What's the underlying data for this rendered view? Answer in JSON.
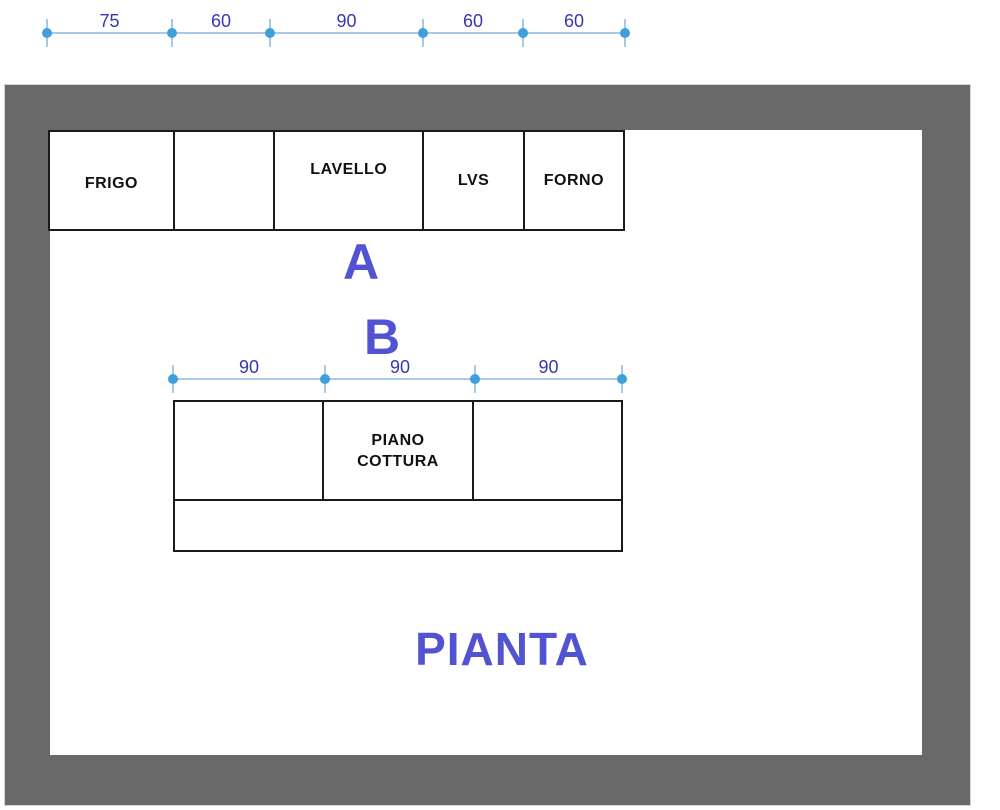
{
  "plan": {
    "title": "PIANTA",
    "section_labels": {
      "a": "A",
      "b": "B"
    },
    "top_run": {
      "dimensions": [
        "75",
        "60",
        "90",
        "60",
        "60"
      ],
      "cells": [
        {
          "label": "FRIGO"
        },
        {
          "label": ""
        },
        {
          "label": "LAVELLO"
        },
        {
          "label": "LVS"
        },
        {
          "label": "FORNO"
        }
      ]
    },
    "island": {
      "dimensions": [
        "90",
        "90",
        "90"
      ],
      "cells": [
        {
          "label": ""
        },
        {
          "label": "PIANO COTTURA"
        },
        {
          "label": ""
        }
      ]
    },
    "colors": {
      "wall": "#696969",
      "dim_line": "#a9c7e7",
      "dim_dot": "#3f9fda",
      "dim_text": "#3737b2",
      "accent_text": "#5253d0",
      "cabinet_border": "#1a1a1a"
    }
  }
}
